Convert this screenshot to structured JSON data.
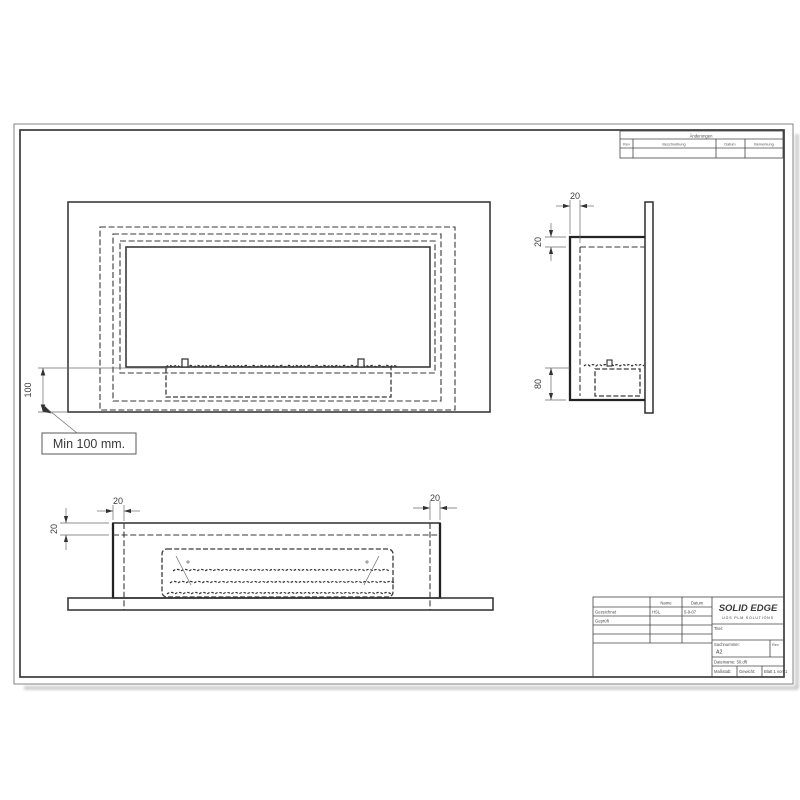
{
  "sheet": {
    "revision_table": {
      "title": "Änderungen",
      "columns": [
        "Rev",
        "Beschreibung",
        "Datum",
        "Bemerkung"
      ]
    },
    "title_block": {
      "name_header": "Name",
      "date_header": "Datum",
      "rows": [
        {
          "label": "Gezeichnet",
          "name": "HSL",
          "date": "5-9-07"
        },
        {
          "label": "Geprüft",
          "name": "",
          "date": ""
        }
      ],
      "logo": "SOLID EDGE",
      "logo_sub": "UGS PLM SOLUTIONS",
      "title_label": "Titel:",
      "doc_number_label": "Sachnummer:",
      "doc_number_value": "A2",
      "rev_label": "Rev",
      "filename": "Dateiname: 50.dft",
      "scale_label": "Maßstab:",
      "weight_label": "Gewicht:",
      "sheet_label": "Blatt 1 von 1"
    },
    "views": {
      "front": {
        "dim_height": "100",
        "callout": "Min 100 mm."
      },
      "side": {
        "dim_top": "20",
        "dim_left_top": "20",
        "dim_left_bottom": "80"
      },
      "bottom": {
        "dim_left_h": "20",
        "dim_left_v": "20",
        "dim_right_h": "20"
      }
    },
    "colors": {
      "line": "#2e2e2e",
      "shadow": "#c4c4c4",
      "paper": "#ffffff"
    }
  }
}
